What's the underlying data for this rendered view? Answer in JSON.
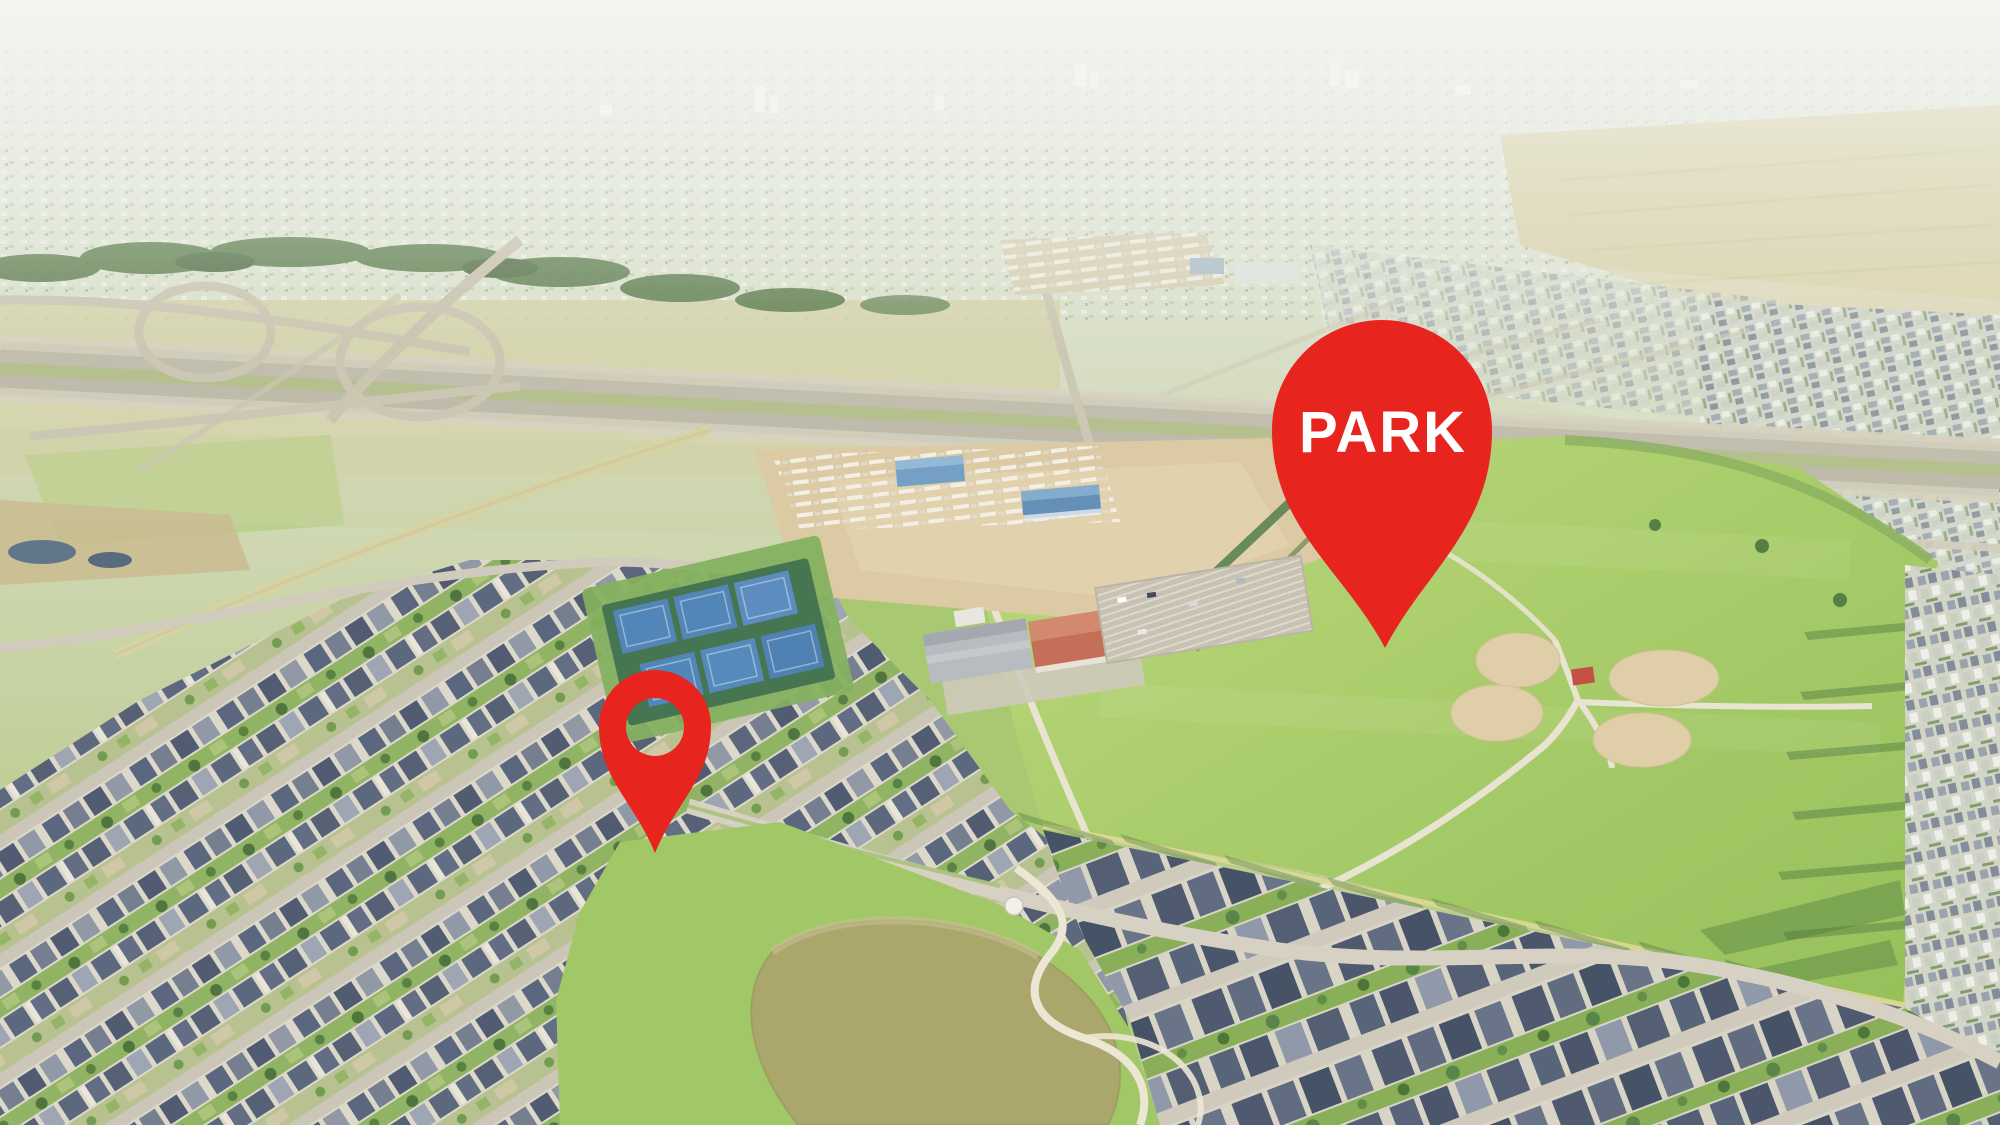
{
  "scene": {
    "type": "aerial-drone-photo",
    "description": "Aerial view of a suburban master-planned community: highway interchange, neighborhoods, school, tennis courts, baseball-diamond park and pond",
    "haze_color": "#edefe8",
    "grass_color": "#a3c765"
  },
  "pins": {
    "park": {
      "label": "PARK",
      "color": "#e8241e",
      "text_color": "#ffffff"
    },
    "property": {
      "label": "",
      "color": "#e8241e"
    }
  }
}
